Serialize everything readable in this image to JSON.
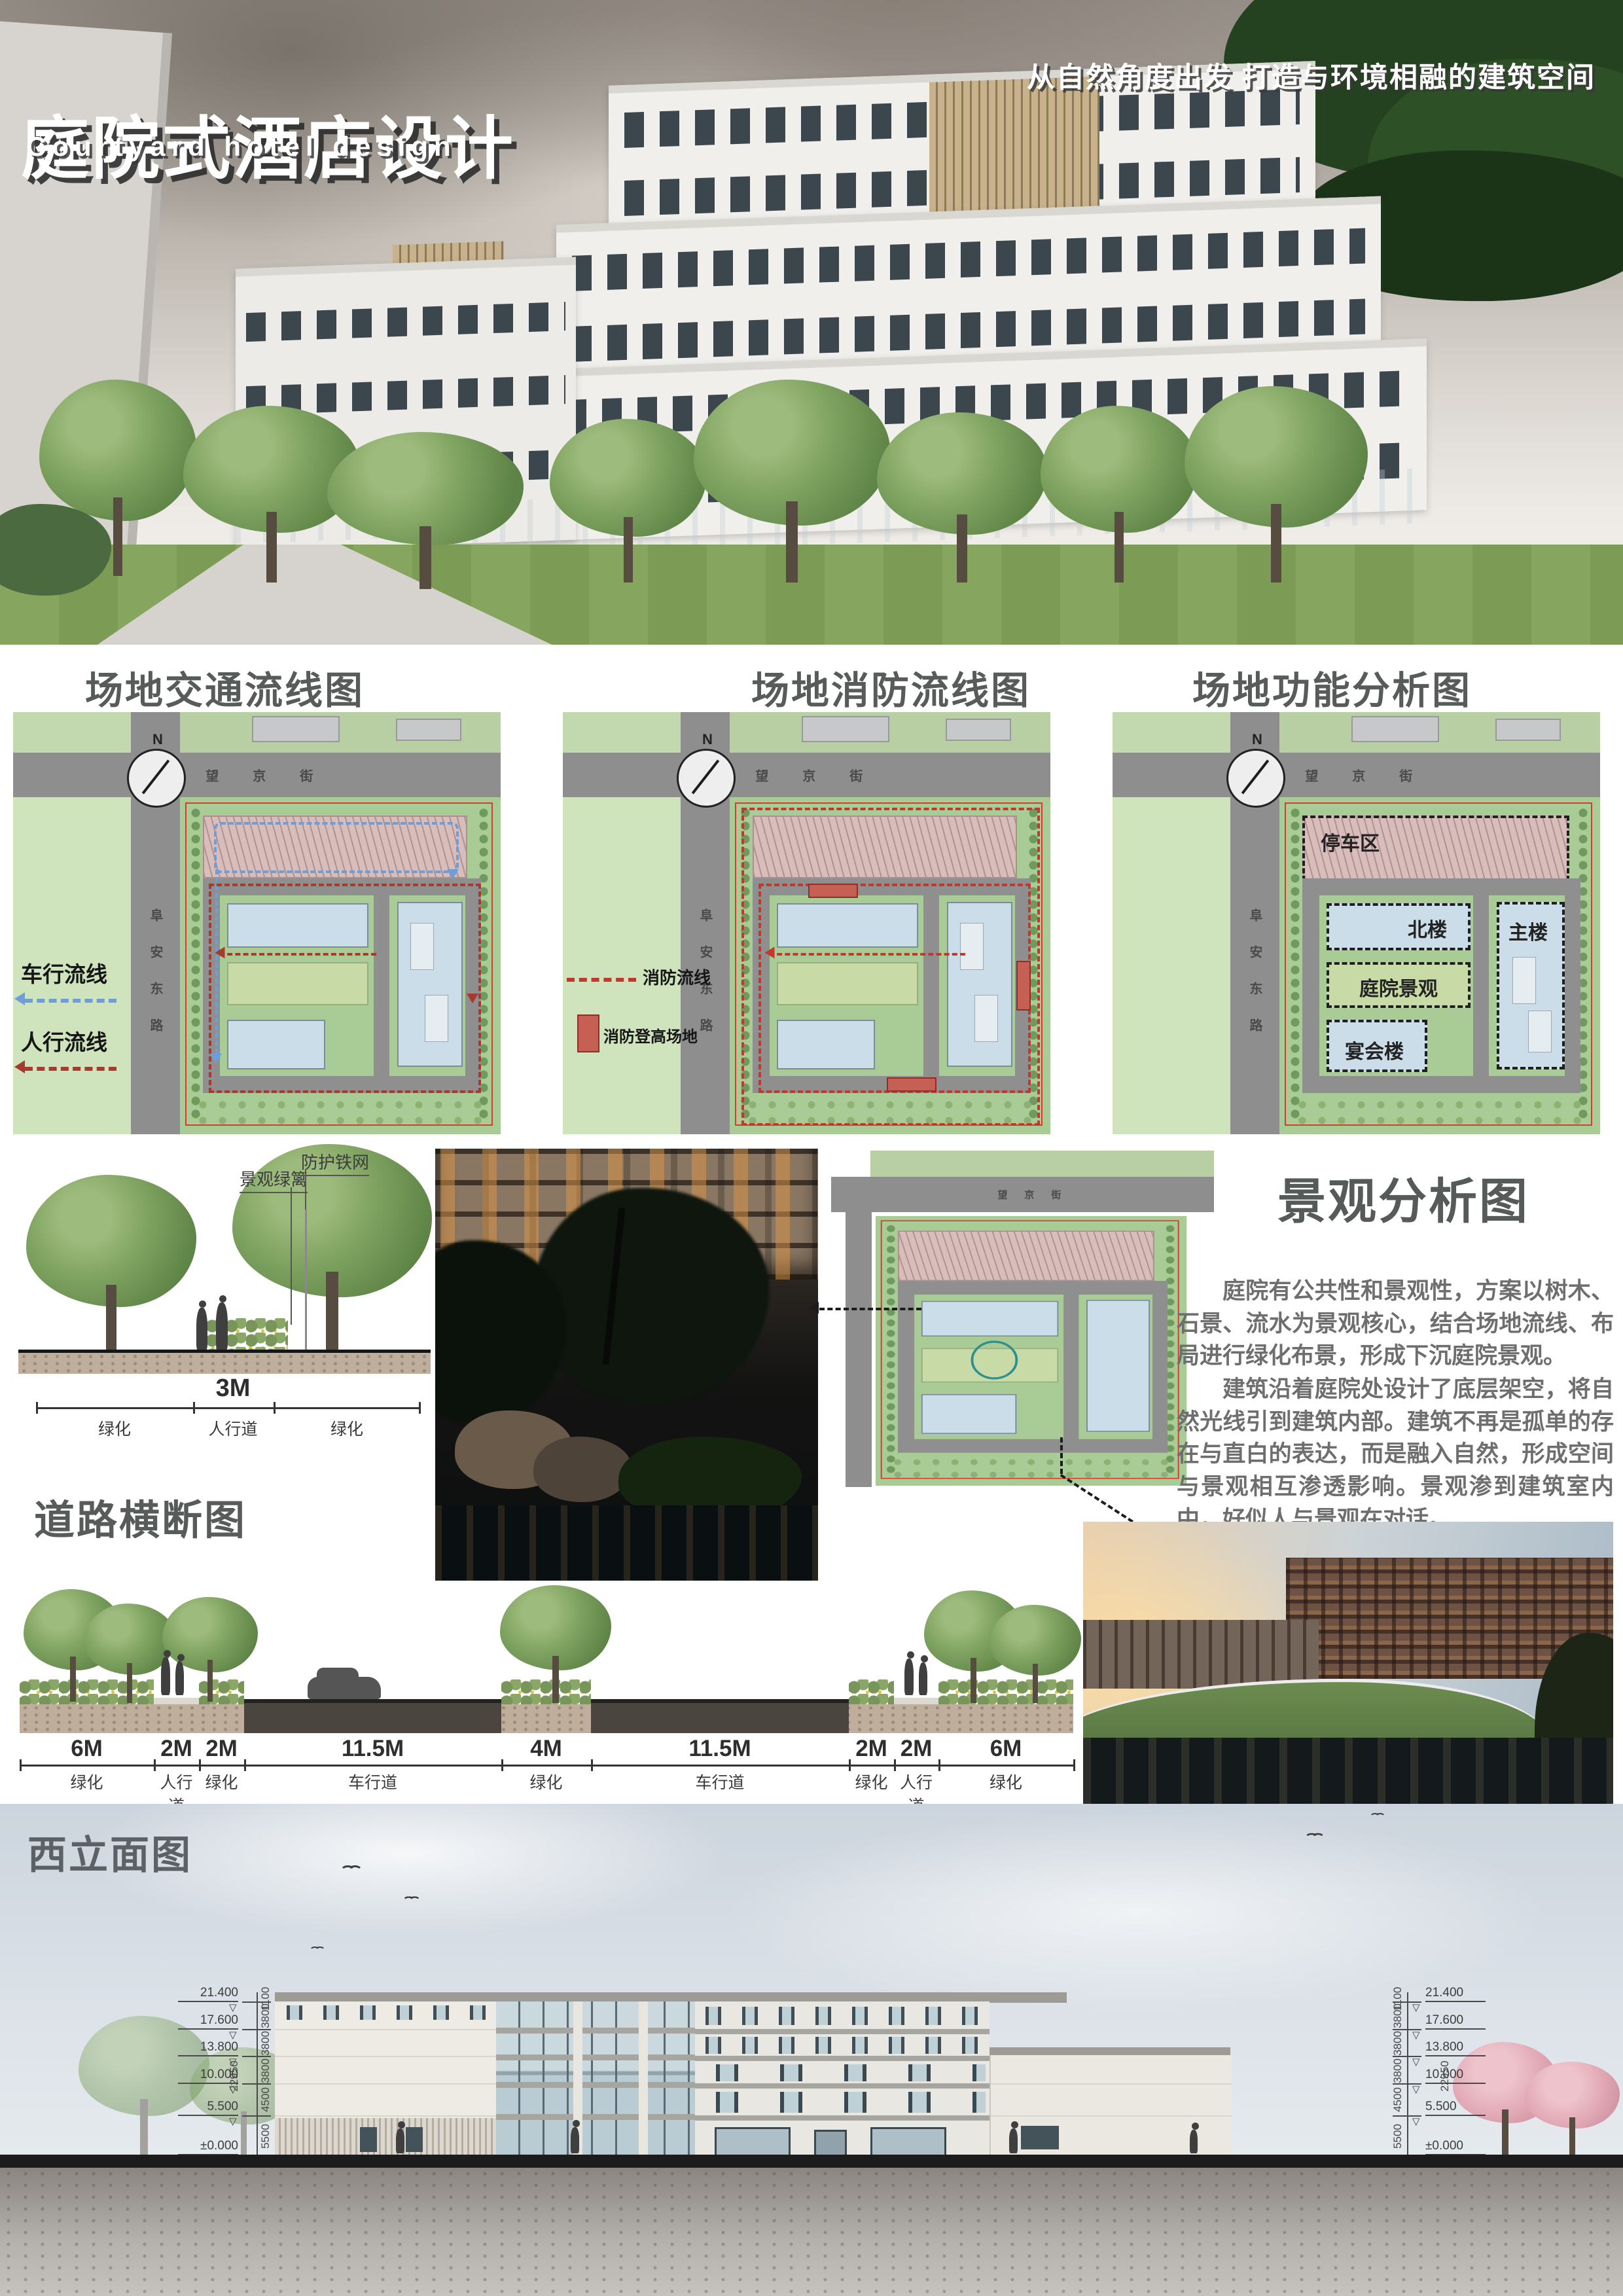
{
  "poster": {
    "title_cn": "庭院式酒店设计",
    "title_en": "Courtyard hotel design",
    "tagline": "从自然角度出发 打造与环境相融的建筑空间"
  },
  "roads": {
    "north_street": "望京街",
    "west_road": "阜安东路",
    "compass": "N"
  },
  "diagram_traffic": {
    "heading": "场地交通流线图",
    "legend_vehicle": "车行流线",
    "legend_pedestrian": "人行流线"
  },
  "diagram_fire": {
    "heading": "场地消防流线图",
    "legend_route": "消防流线",
    "legend_area": "消防登高场地"
  },
  "diagram_function": {
    "heading": "场地功能分析图",
    "zone_parking": "停车区",
    "zone_north": "北楼",
    "zone_main": "主楼",
    "zone_courtyard": "庭院景观",
    "zone_banquet": "宴会楼"
  },
  "landscape_analysis": {
    "heading": "景观分析图",
    "paragraph1": "庭院有公共性和景观性，方案以树木、石景、流水为景观核心，结合场地流线、布局进行绿化布景，形成下沉庭院景观。",
    "paragraph2": "建筑沿着庭院处设计了底层架空，将自然光线引到建筑内部。建筑不再是孤单的存在与直白的表达，而是融入自然，形成空间与景观相互渗透影响。景观渗到建筑室内中，好似人与景观在对话。"
  },
  "tree_section": {
    "label_fence": "防护铁网",
    "label_hedge": "景观绿篱",
    "dim_width": "3M",
    "seg_left": "绿化",
    "seg_mid": "人行道",
    "seg_right": "绿化"
  },
  "road_section": {
    "heading": "道路横断图",
    "segments": [
      {
        "dim": "6M",
        "label": "绿化"
      },
      {
        "dim": "2M",
        "label": "人行道"
      },
      {
        "dim": "2M",
        "label": "绿化"
      },
      {
        "dim": "11.5M",
        "label": "车行道"
      },
      {
        "dim": "4M",
        "label": "绿化"
      },
      {
        "dim": "11.5M",
        "label": "车行道"
      },
      {
        "dim": "2M",
        "label": "绿化"
      },
      {
        "dim": "2M",
        "label": "人行道"
      },
      {
        "dim": "6M",
        "label": "绿化"
      }
    ]
  },
  "elevation": {
    "heading": "西立面图",
    "levels": [
      "21.400",
      "17.600",
      "13.800",
      "10.000",
      "5.500",
      "±0.000"
    ],
    "floor_dims": [
      "1100",
      "3800",
      "3800",
      "3800",
      "4500",
      "5500"
    ],
    "total_height": "22950",
    "base_level": "-0.450"
  },
  "colors": {
    "heading_gray": "#575c5a",
    "vehicle_blue": "#6d9ed9",
    "pedestrian_red": "#a63a2e",
    "fire_red": "#bf3a2c",
    "site_green": "#a9cb96",
    "parking_pink": "#d9bdbb",
    "building_blue": "#cbdde8"
  }
}
